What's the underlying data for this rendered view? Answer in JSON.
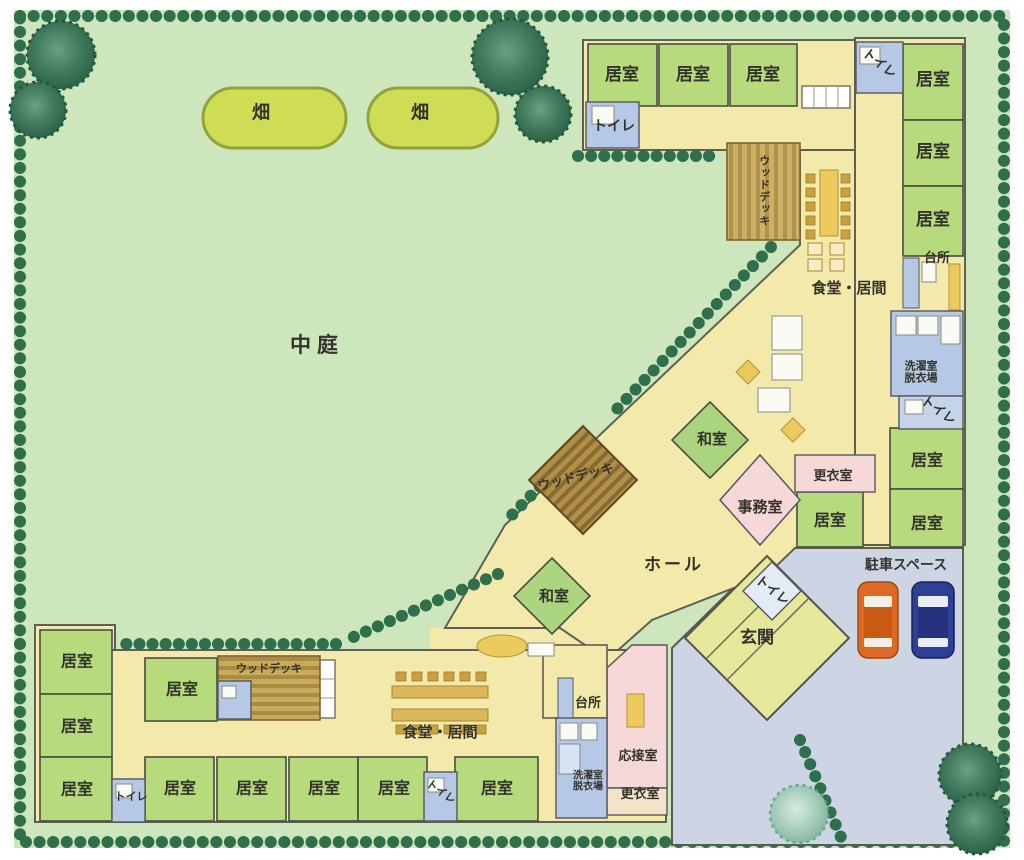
{
  "document": {
    "type": "facility site / floor plan (scanned, Japanese group-home style layout)",
    "orientation": "L-shaped building around a large courtyard, parking at lower right"
  },
  "labels": {
    "courtyard": "中庭",
    "field": "畑",
    "room": "居室",
    "toilet": "トイレ",
    "wood_deck": "ウッドデッキ",
    "dining_living": "食堂・居間",
    "kitchen": "台所",
    "laundry_line1": "洗濯室",
    "laundry_line2": "脱衣場",
    "japanese_room": "和室",
    "hall": "ホール",
    "office": "事務室",
    "changing_room": "更衣室",
    "entrance": "玄関",
    "parking": "駐車スペース",
    "reception_room": "応接室"
  },
  "label_counts": {
    "居室": 18,
    "トイレ": 6,
    "ウッドデッキ": 3,
    "和室": 2,
    "畑": 2,
    "食堂・居間": 2,
    "台所": 2,
    "更衣室": 2,
    "洗濯室/脱衣場": 2,
    "中庭": 1,
    "ホール": 1,
    "事務室": 1,
    "玄関": 1,
    "駐車スペース": 1,
    "応接室": 1
  },
  "colors": {
    "lawn": "#cde6bc",
    "floor": "#f3e9ab",
    "room_green": "#b7da7d",
    "water_blue": "#b5c9e6",
    "pink": "#f7d8d9",
    "parking": "#cdd5e4",
    "deck_brown": "#b08f49",
    "field_green": "#cfdd55",
    "hedge_green": "#2f6f4c",
    "entrance_green": "#e5e89b",
    "car_orange": "#dd6a24",
    "car_blue": "#2e3f96"
  },
  "vehicles": {
    "count": 2,
    "colors": [
      "orange",
      "dark blue"
    ]
  }
}
